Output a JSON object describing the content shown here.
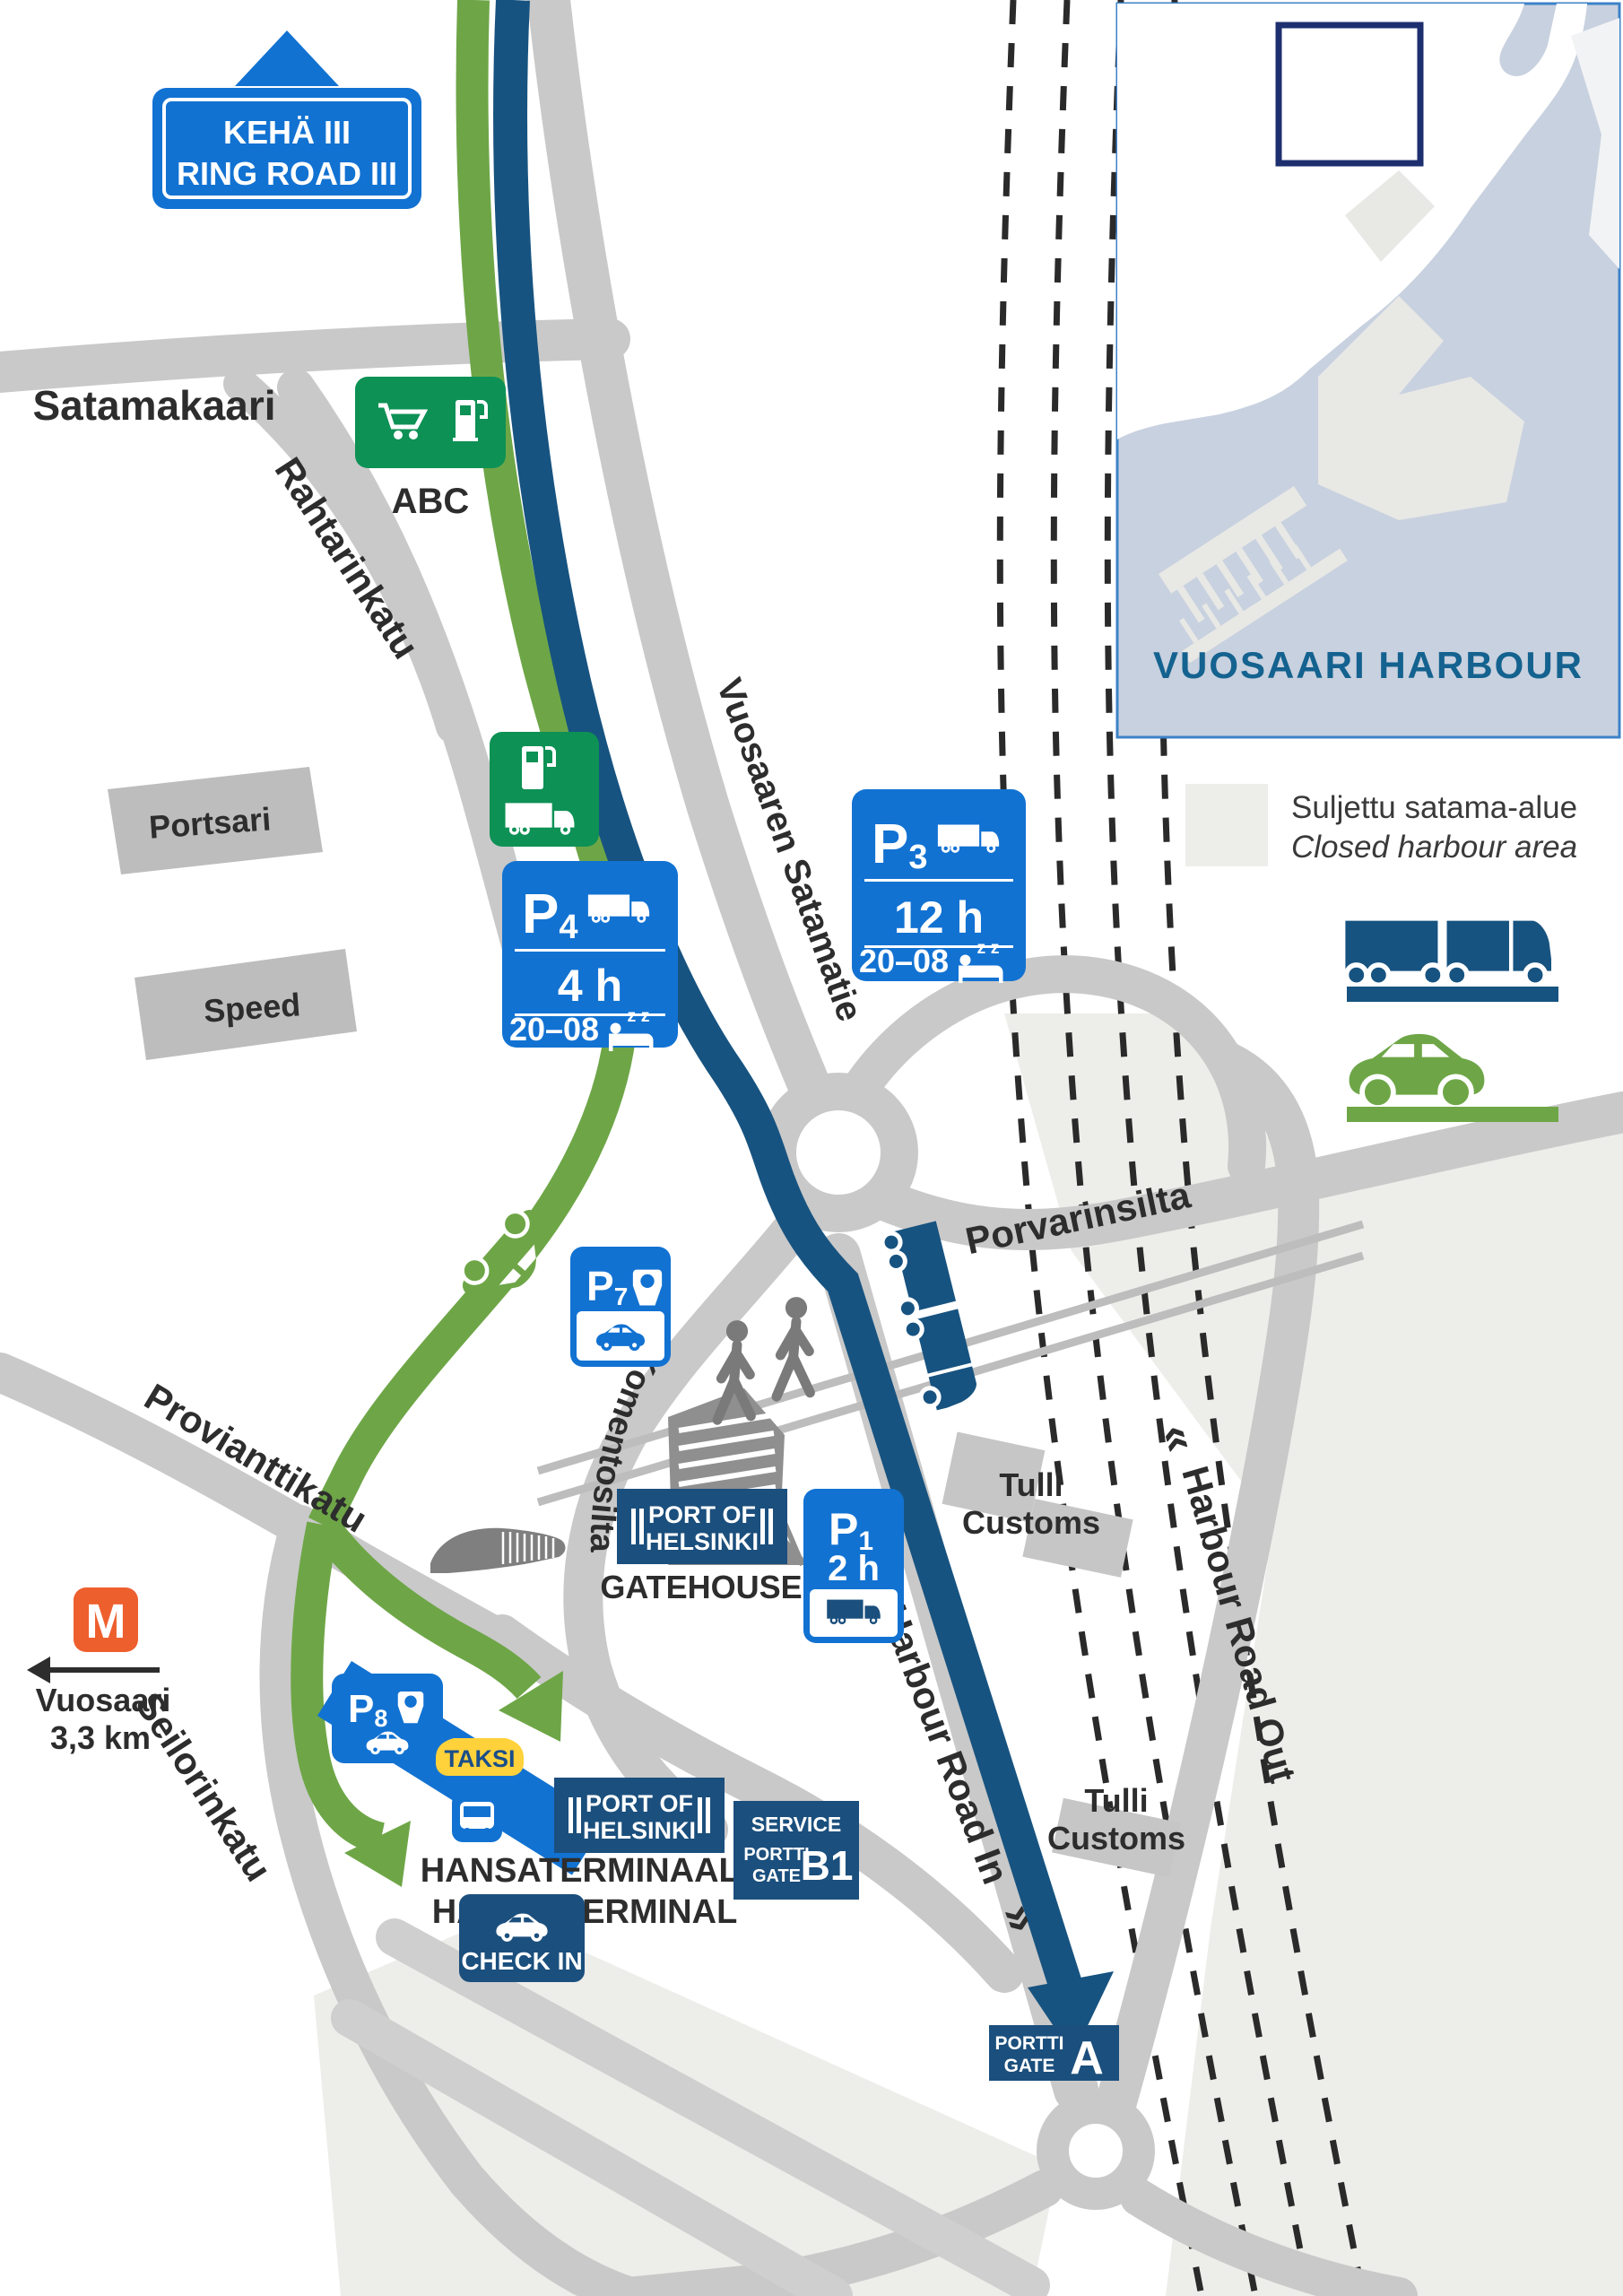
{
  "colors": {
    "sign_blue": "#1272D2",
    "route_navy": "#175380",
    "box_navy": "#1B4F7D",
    "route_green": "#6EA647",
    "station_green": "#0D9155",
    "road_gray": "#C9C9C9",
    "closed_area_gray": "#EDEDEA",
    "metro_orange": "#EE5F2E",
    "taksi_yellow": "#FFD23B"
  },
  "ring_road_sign": {
    "line1": "KEHÄ III",
    "line2": "RING ROAD III"
  },
  "roads": {
    "satamakaari": "Satamakaari",
    "rahtarinkatu": "Rahtarinkatu",
    "vuosaaren_satamatie": "Vuosaaren Satamatie",
    "porvarinsilta": "Porvarinsilta",
    "provianttikatu": "Provianttikatu",
    "komentosilta": "Komentosilta",
    "seilorinkatu": "Seilorinkatu",
    "harbour_road_in": "Harbour Road In",
    "harbour_road_out": "Harbour Road Out",
    "chevrons_in": "»",
    "chevrons_out": "«"
  },
  "buildings": {
    "portsari": "Portsari",
    "speed": "Speed",
    "tulli_upper": {
      "line1": "Tulli",
      "line2": "Customs"
    },
    "tulli_lower": {
      "line1": "Tulli",
      "line2": "Customs"
    }
  },
  "abc_station": {
    "label": "ABC"
  },
  "parking": {
    "p3": {
      "letter": "P",
      "number": "3",
      "duration": "12 h",
      "night_hours": "20–08",
      "sleep": "z z"
    },
    "p4": {
      "letter": "P",
      "number": "4",
      "duration": "4 h",
      "night_hours": "20–08",
      "sleep": "z z"
    },
    "p7": {
      "letter": "P",
      "number": "7"
    },
    "p1": {
      "letter": "P",
      "number": "1",
      "duration": "2 h"
    },
    "p8": {
      "letter": "P",
      "number": "8"
    }
  },
  "terminal": {
    "taksi": "TAKSI",
    "bus_line": "90",
    "port_of_helsinki": {
      "line1": "PORT OF",
      "line2": "HELSINKI"
    },
    "gatehouse": "GATEHOUSE",
    "name_fi": "HANSATERMINAALI",
    "name_en": "HANSA TERMINAL",
    "check_in": "CHECK IN",
    "service_gate": {
      "service": "SERVICE",
      "portti": "PORTTI",
      "gate": "GATE",
      "code": "B1"
    },
    "gate_a": {
      "portti": "PORTTI",
      "gate": "GATE",
      "code": "A"
    }
  },
  "metro": {
    "symbol": "M",
    "destination": "Vuosaari",
    "distance": "3,3 km"
  },
  "legend": {
    "closed_area_fi": "Suljettu satama-alue",
    "closed_area_en": "Closed harbour area"
  },
  "inset": {
    "title": "VUOSAARI HARBOUR"
  }
}
